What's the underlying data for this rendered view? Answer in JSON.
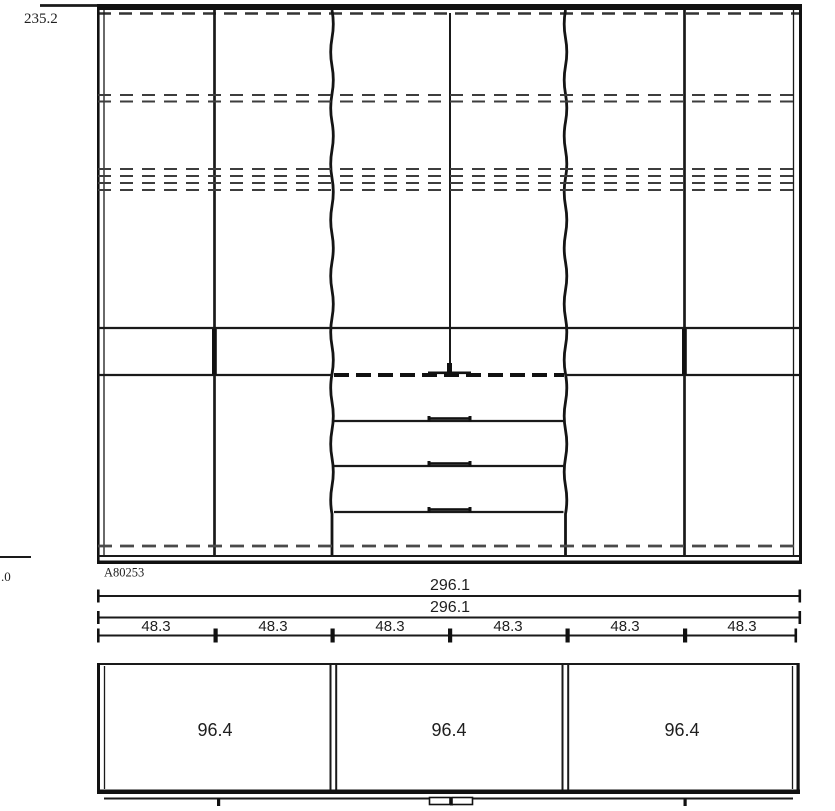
{
  "labels": {
    "height_total": "235.2",
    "left_partial": ".0",
    "item_code": "A80253",
    "width_total_top": "296.1",
    "width_total_bottom": "296.1",
    "sections": [
      "48.3",
      "48.3",
      "48.3",
      "48.3",
      "48.3",
      "48.3"
    ],
    "plan_sections": [
      "96.4",
      "96.4",
      "96.4"
    ]
  },
  "colors": {
    "line": "#1a1a1a",
    "dashed_line": "#3d3d3d",
    "plinth_dash": "#4a4a4a",
    "text": "#1f1f1f",
    "background": "#ffffff"
  }
}
